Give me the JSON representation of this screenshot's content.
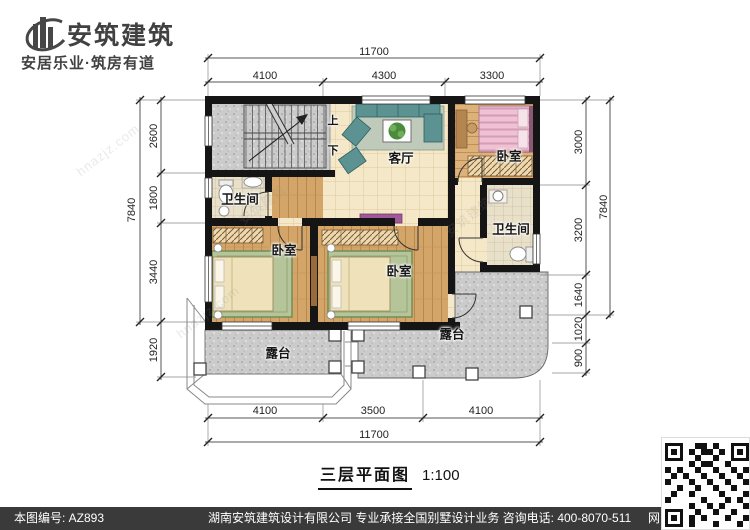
{
  "brand": {
    "logo_text": "安筑建筑",
    "slogan": "安居乐业·筑房有道"
  },
  "plan": {
    "room_labels": {
      "living_room": "客厅",
      "bedroom_top": "卧室",
      "bedroom_left": "卧室",
      "bedroom_middle": "卧室",
      "bathroom_left": "卫生间",
      "bathroom_right": "卫生间",
      "terrace_left": "露台",
      "terrace_right": "露台",
      "stairs_up": "上",
      "stairs_down": "下"
    },
    "dimensions": {
      "top": {
        "total": "11700",
        "segments": [
          "4100",
          "4300",
          "3300"
        ]
      },
      "bottom": {
        "total": "11700",
        "segments": [
          "4100",
          "3500",
          "4100"
        ]
      },
      "left": {
        "total": "7840",
        "segments": [
          "2600",
          "1800",
          "3440",
          "1920"
        ]
      },
      "right": {
        "total": "7840",
        "segments": [
          "3000",
          "3200",
          "1640",
          "1020",
          "900"
        ]
      }
    }
  },
  "title": {
    "name": "三层平面图",
    "scale": "1:100"
  },
  "footer": {
    "drawing_number": "本图编号: AZ893",
    "info": "湖南安筑建筑设计有限公司  专业承接全国别墅设计业务  咨询电话: 400-8070-511",
    "web_char": "网"
  },
  "watermarks": [
    "hnazjz.com",
    "安筑建筑",
    "安筑建筑",
    "hnazjz.com",
    "hnazjz.com"
  ],
  "colors": {
    "wall": "#151515",
    "floor_tile": "#f4e8c8",
    "floor_wood": "#d3a568",
    "terrace_gray": "#cbcbcb",
    "footer_bar": "#3a3a3a"
  }
}
